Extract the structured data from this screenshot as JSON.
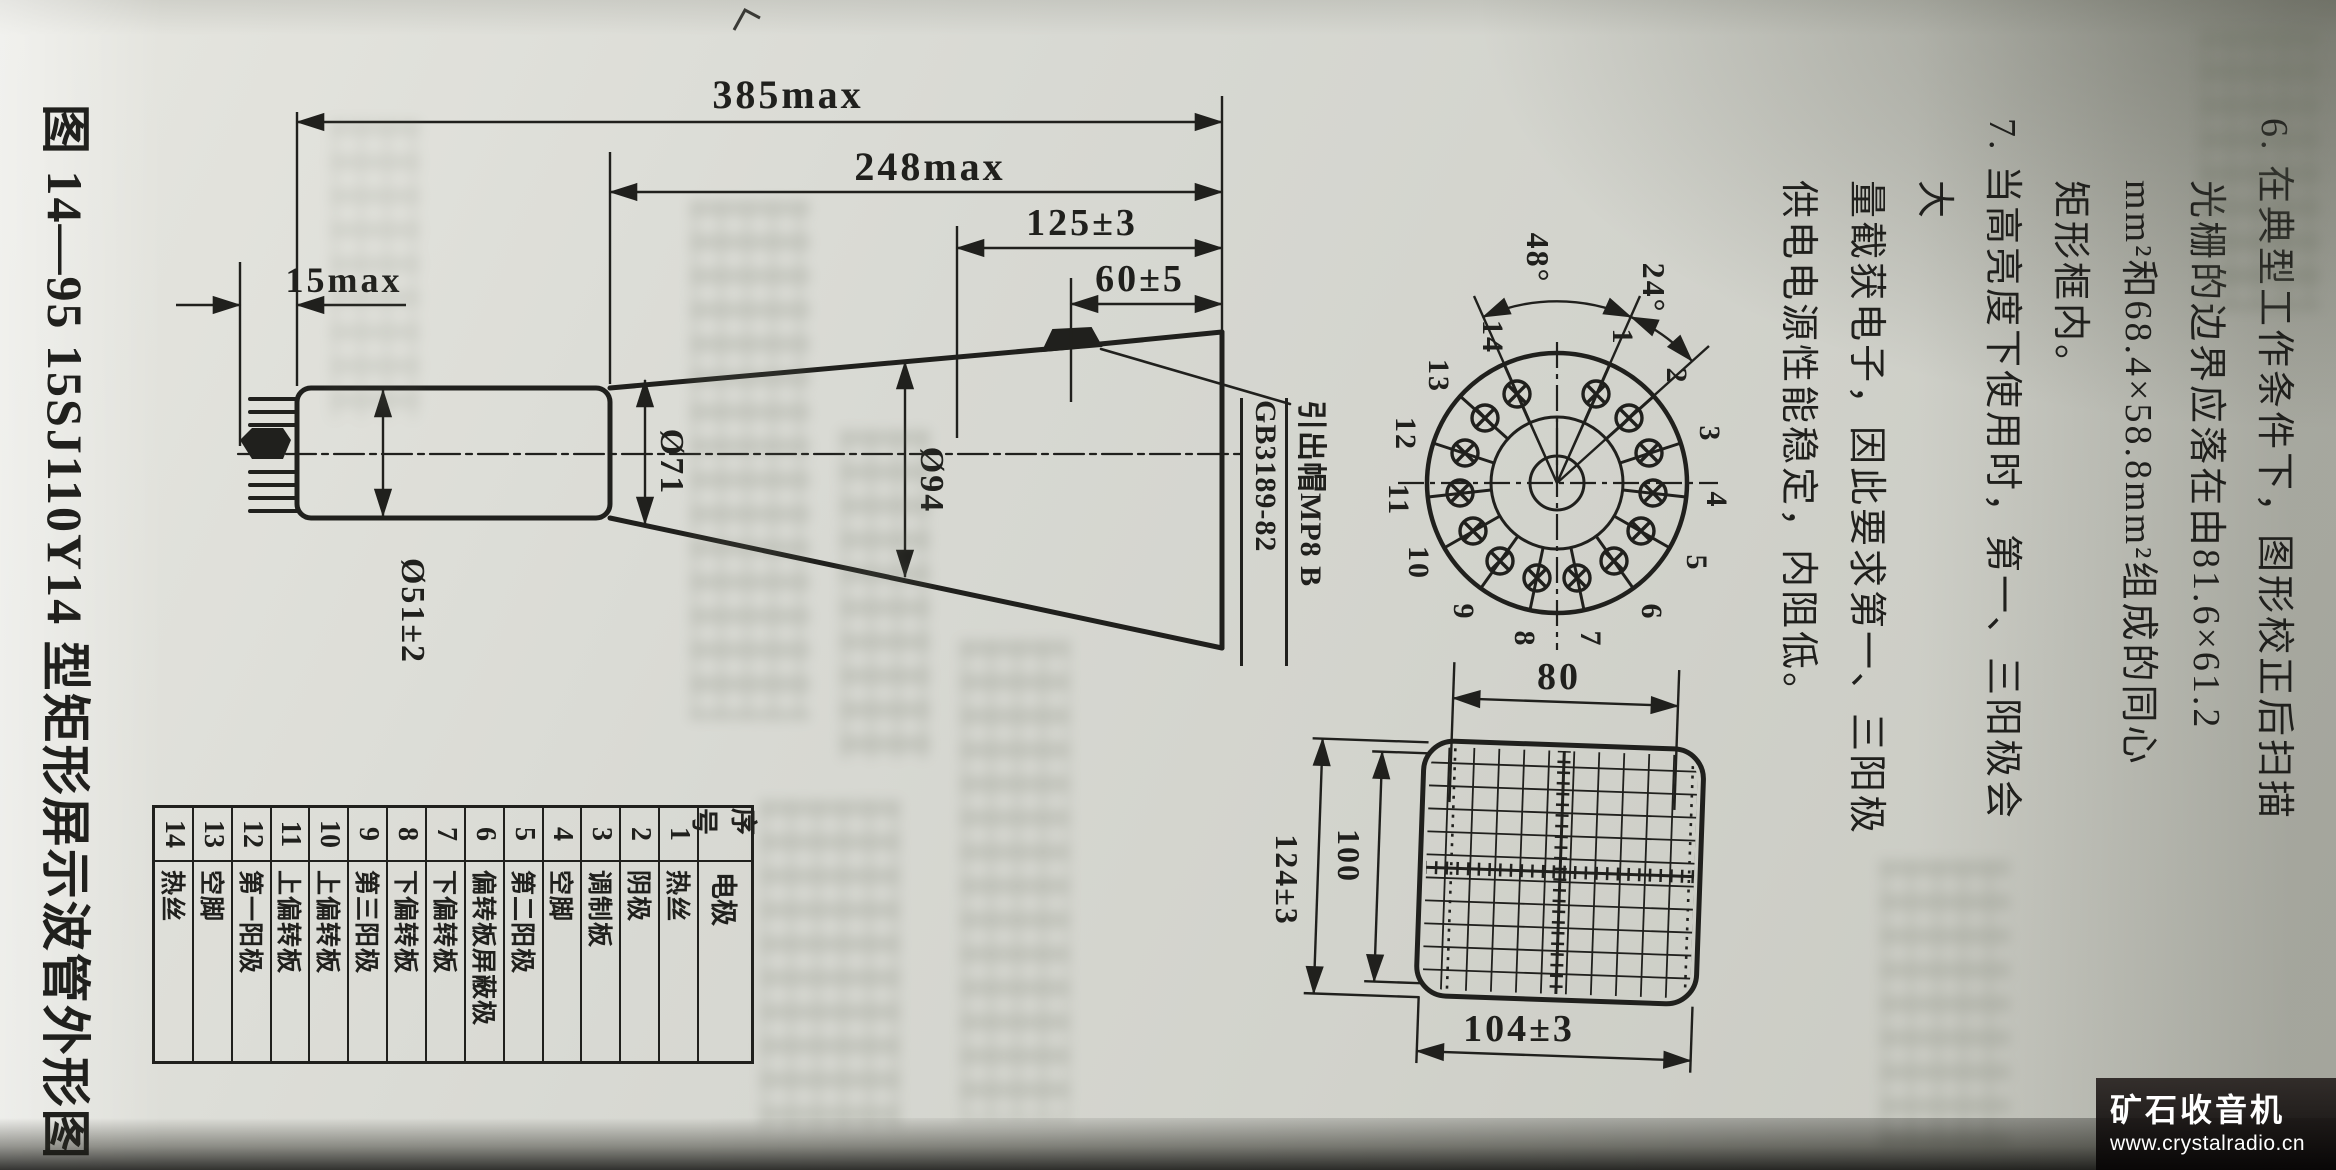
{
  "page": {
    "caption": "图 14—95  15SJ110Y14 型矩形屏示波管外形图",
    "paragraph_6": "6. 在典型工作条件下，图形校正后扫描\n光栅的边界应落在由81.6×61.2\nmm²和68.4×58.8mm²组成的同心\n矩形框内。",
    "paragraph_7": "7. 当高亮度下使用时，第一、三阳极会大\n量截获电子，因此要求第一、三阳极\n供电电源性能稳定，内阻低。"
  },
  "drawing": {
    "dim_overall": "385max",
    "dim_body": "248max",
    "dim_front": "125±3",
    "dim_cap": "60±5",
    "dim_pins": "15max",
    "dia_base": "Ø51±2",
    "dia_neck": "Ø71",
    "dia_cone": "Ø94",
    "cap_label": "引出帽MP8 B",
    "cap_standard": "GB3189-82"
  },
  "pin_diagram": {
    "angle_gap": "48°",
    "angle_pitch": "24°",
    "pins": [
      "1",
      "2",
      "3",
      "4",
      "5",
      "6",
      "7",
      "8",
      "9",
      "10",
      "11",
      "12",
      "13",
      "14"
    ]
  },
  "screen_view": {
    "dim_raster_width": "80",
    "dim_raster_height": "100",
    "dim_outer_height": "124±3",
    "dim_outer_width": "104±3"
  },
  "table": {
    "headers": [
      "序号",
      "电极"
    ],
    "rows": [
      [
        "1",
        "热丝"
      ],
      [
        "2",
        "阴极"
      ],
      [
        "3",
        "调制板"
      ],
      [
        "4",
        "空脚"
      ],
      [
        "5",
        "第二阳极"
      ],
      [
        "6",
        "偏转板屏蔽极"
      ],
      [
        "7",
        "下偏转板"
      ],
      [
        "8",
        "下偏转板"
      ],
      [
        "9",
        "第三阳极"
      ],
      [
        "10",
        "上偏转板"
      ],
      [
        "11",
        "上偏转板"
      ],
      [
        "12",
        "第一阳极"
      ],
      [
        "13",
        "空脚"
      ],
      [
        "14",
        "热丝"
      ]
    ]
  },
  "watermark": {
    "title": "矿石收音机",
    "url": "www.crystalradio.cn"
  }
}
